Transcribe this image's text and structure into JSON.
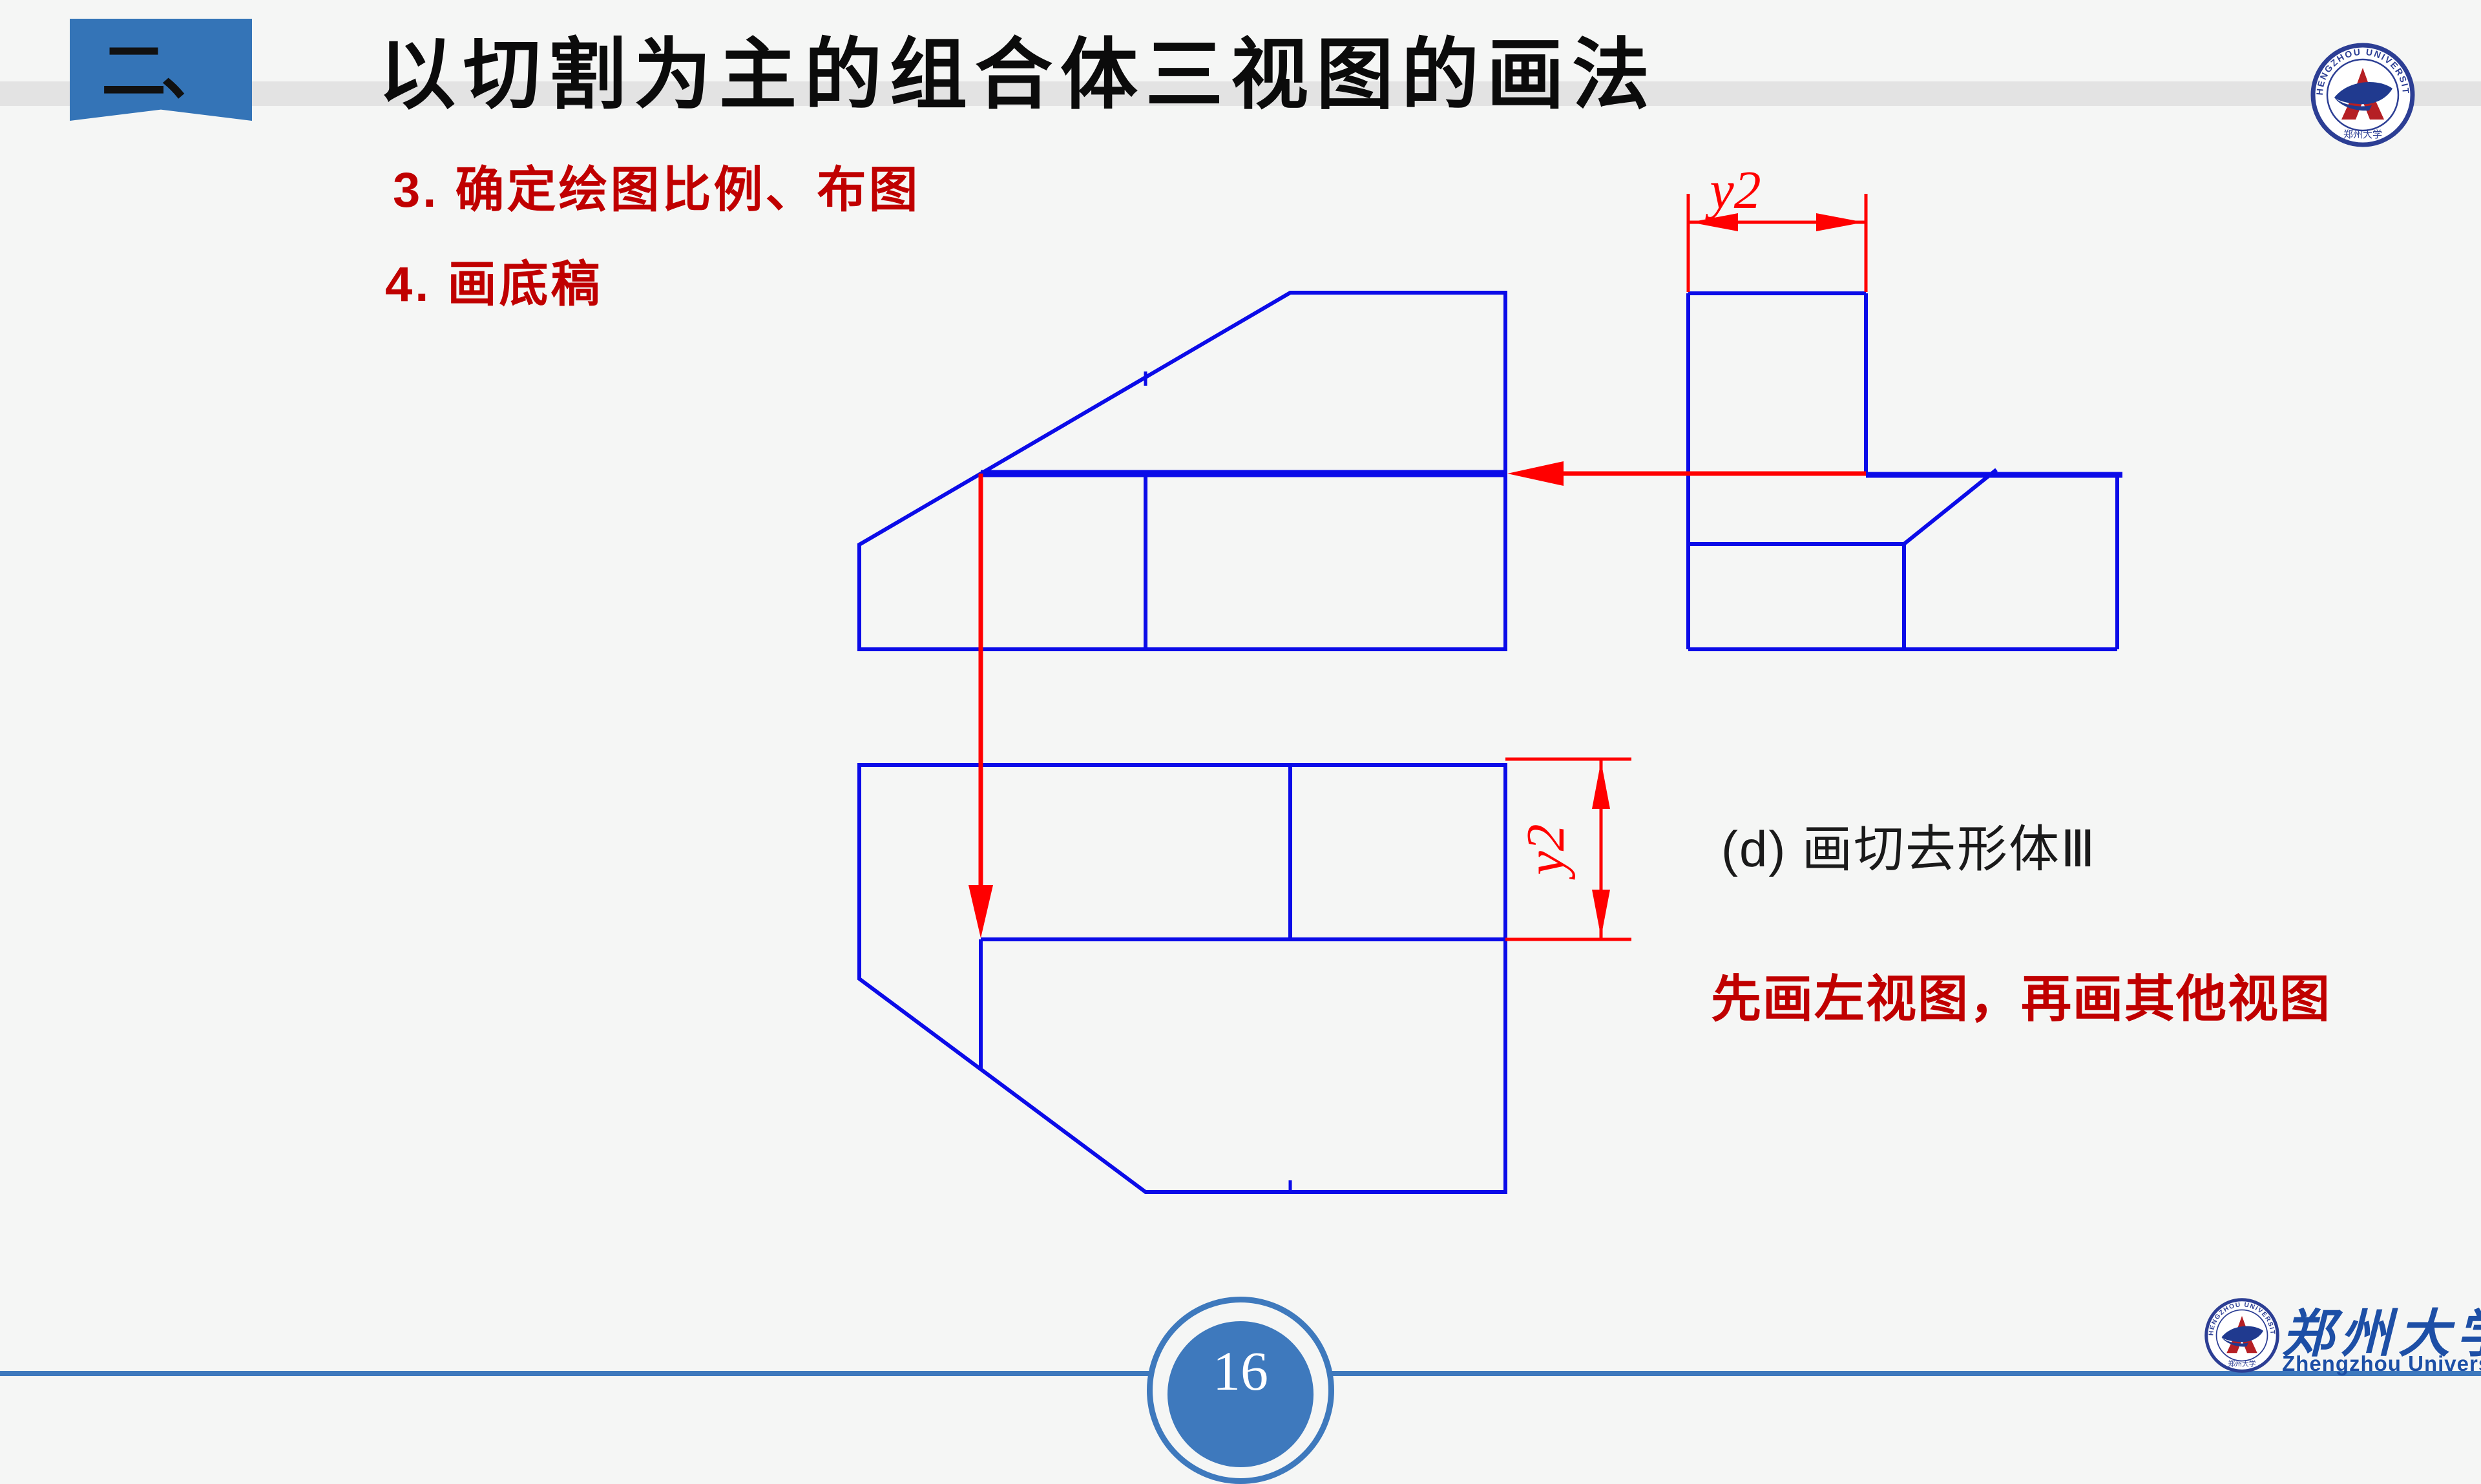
{
  "colors": {
    "background": "#f5f6f5",
    "header_band": "#e3e3e3",
    "ribbon_blue": "#3474b7",
    "footer_blue": "#3e79bd",
    "cad_blue": "#0b0be8",
    "cad_red": "#ff0000",
    "heading_red": "#c00000",
    "logo_navy": "#2c3e94",
    "logo_blue": "#1d4fa6"
  },
  "header": {
    "badge": "二、",
    "title": "以切割为主的组合体三视图的画法"
  },
  "bullets": {
    "b3": "3. 确定绘图比例、布图",
    "b4": "4. 画底稿"
  },
  "dims": {
    "top": "y2",
    "right": "y2"
  },
  "caption": "(d) 画切去形体Ⅲ",
  "note": "先画左视图，再画其他视图",
  "footer": {
    "page": "16"
  },
  "logos": {
    "arc_text": "ZHENGZHOU UNIVERSITY",
    "cn": "郑州大学",
    "en": "Zhengzhou University"
  }
}
